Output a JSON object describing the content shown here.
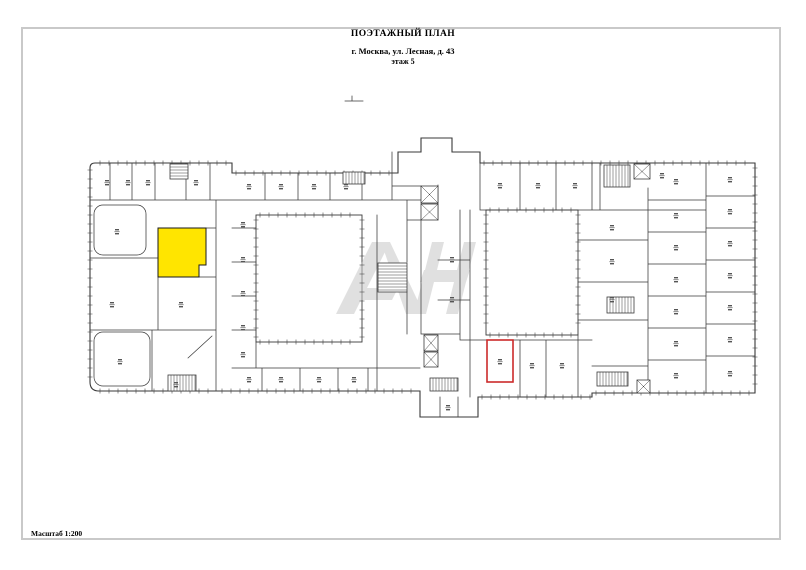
{
  "header": {
    "title": "ПОЭТАЖНЫЙ ПЛАН",
    "address": "г. Москва, ул. Лесная, д. 43",
    "floor": "этаж 5"
  },
  "footer": {
    "scale_label": "Масштаб 1:200"
  },
  "colors": {
    "highlight": "#ffe500",
    "selection": "#cc2b2b",
    "watermark": "#c8c8c8",
    "line": "#3a3a3a",
    "frame": "#c9c9c9",
    "label": "#555555"
  }
}
